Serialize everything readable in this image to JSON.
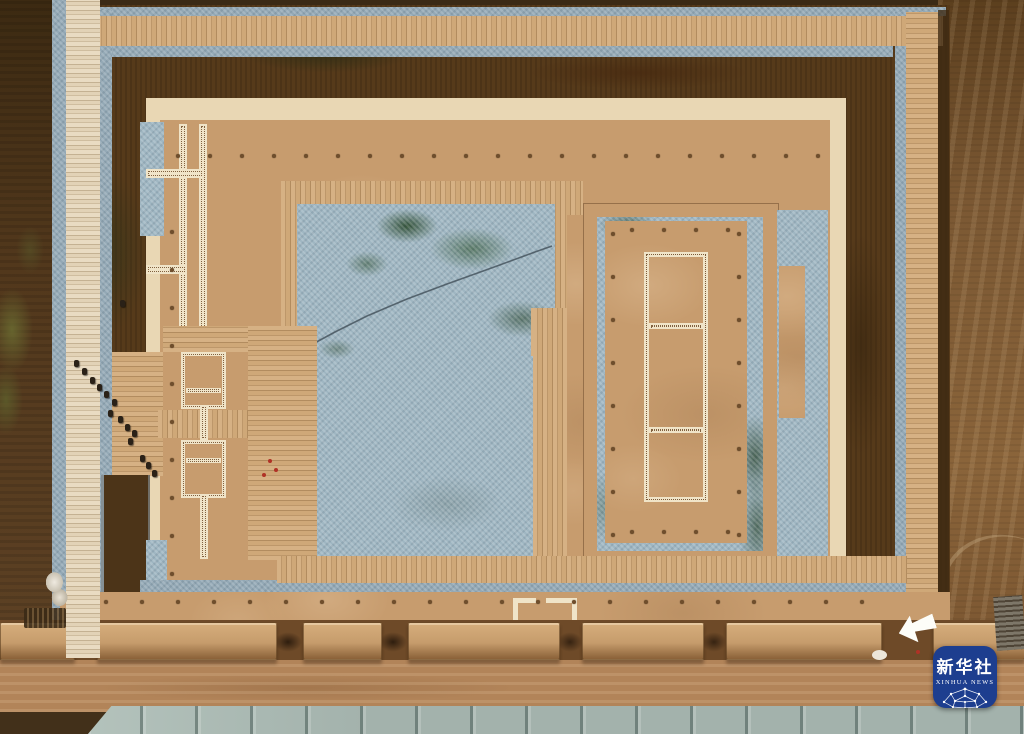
{
  "image": {
    "type": "aerial drone photograph",
    "subject": "Excavated archaeological ruins: nested rammed-earth platforms, blue gravel courtyards, wooden boardwalks, ruined wall segments and a dirt road"
  },
  "watermark": {
    "agency_cn": "新华社",
    "agency_en": "XINHUA NEWS",
    "badge_color": "#1d3e8f",
    "text_color": "#ffffff"
  },
  "palette": {
    "fielddark": "#42301a",
    "fieldleft": "#52381c",
    "fieldright": "#7b5833",
    "moat": "#563a1a",
    "gravel": "#93a8b5",
    "court": "#9fb6c2",
    "cream": "#e9d7b4",
    "tan": "#c79c6e",
    "whitewall": "#f0e4c8",
    "dot": "#6f4e2c",
    "road": "#b28459",
    "pave": "#a3b2ac",
    "logoblue": "#1d3e8f"
  }
}
